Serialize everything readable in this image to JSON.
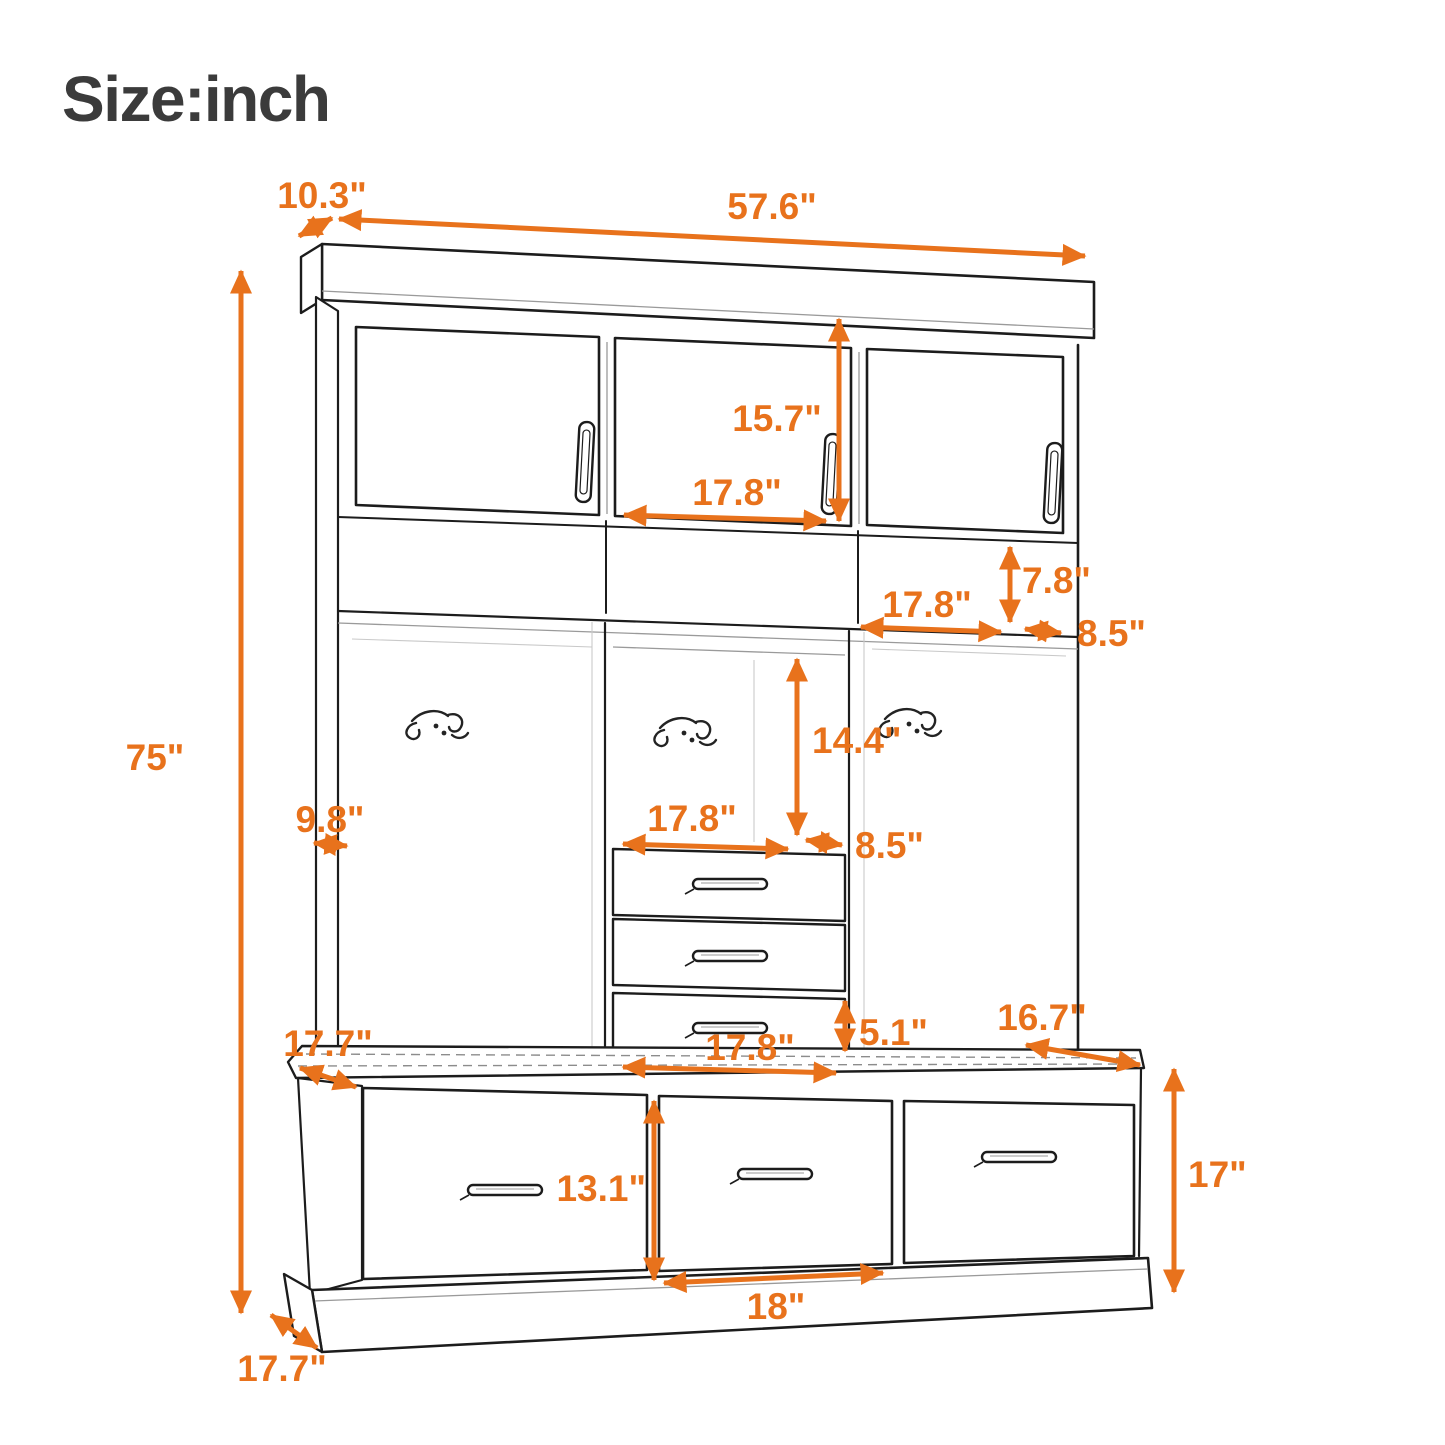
{
  "title": "Size:inch",
  "unit": "inch",
  "colors": {
    "dimension": "#E8721C",
    "outline": "#1C1C1C",
    "title_text": "#3B3B3B",
    "background": "#FFFFFF"
  },
  "dimensions": {
    "top_depth": "10.3\"",
    "overall_width": "57.6\"",
    "overall_height": "75\"",
    "upper_door_height": "15.7\"",
    "upper_door_width": "17.8\"",
    "open_shelf_height": "7.8\"",
    "open_shelf_width": "17.8\"",
    "upper_side_depth": "8.5\"",
    "open_compartment_height": "14.4\"",
    "open_compartment_width": "17.8\"",
    "middle_depth": "8.5\"",
    "left_side_depth": "9.8\"",
    "small_drawer_height": "5.1\"",
    "small_drawer_width": "17.8\"",
    "bench_top_depth_left": "17.7\"",
    "bench_top_depth_right": "16.7\"",
    "bench_drawer_height": "13.1\"",
    "bench_height": "17\"",
    "bench_drawer_width": "18\"",
    "base_depth": "17.7\""
  }
}
